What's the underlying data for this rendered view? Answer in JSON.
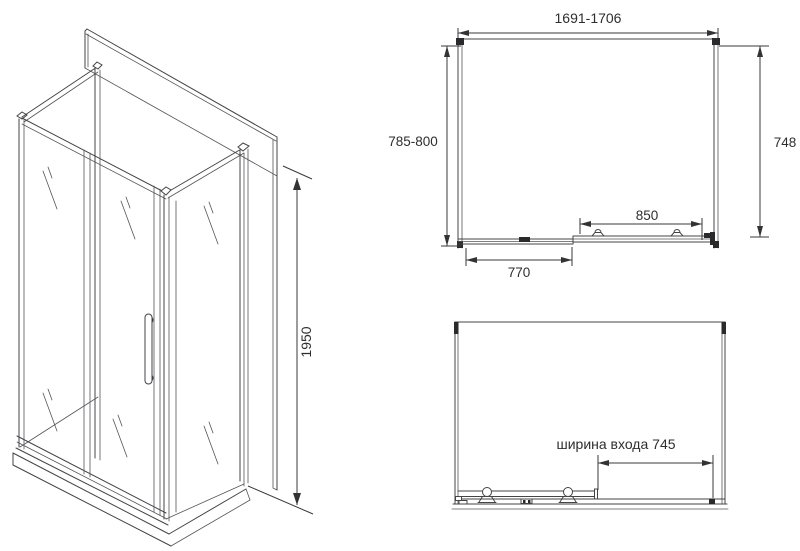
{
  "drawing": {
    "kind": "shower-enclosure-technical-drawing",
    "colors": {
      "background": "#ffffff",
      "line": "#444446",
      "text": "#2e2e30"
    },
    "iso_view": {
      "height_label": "1950"
    },
    "plan_view": {
      "overall_width_label": "1691-1706",
      "depth_range_label": "785-800",
      "inner_depth_label": "748",
      "door_width_label": "850",
      "fixed_panel_label": "770"
    },
    "front_view": {
      "entry_width_label": "ширина входа 745"
    }
  }
}
